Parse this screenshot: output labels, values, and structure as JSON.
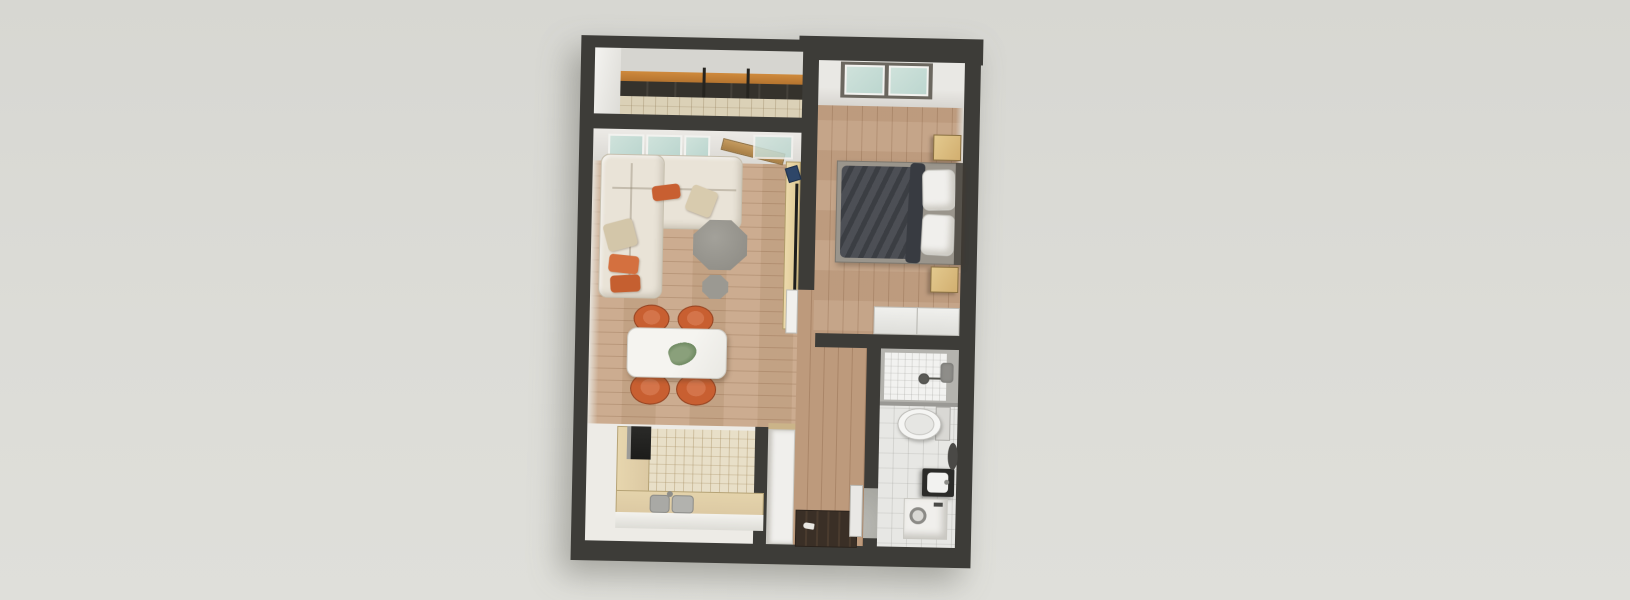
{
  "scene": {
    "description": "3D rendered top-down floor plan of a one-bedroom apartment",
    "view": "top-down axonometric render",
    "background_color": "#dcdcd7"
  },
  "palette": {
    "wall": "#3d3c38",
    "wood_living": "#c9a88a",
    "wood_bedroom": "#c2a083",
    "wood_corridor": "#bd9a7c",
    "tile_balcony": "#dbd1b7",
    "mosaic": "#e8dfc8",
    "bath_floor": "#e7e7e4",
    "sofa": "#e9e3d7",
    "orange": "#c85f31",
    "duvet": "#43464c",
    "counter": "#dcc9a3",
    "glass": "#bcd6cf",
    "white_furn": "#f0efec",
    "nightstand": "#d2af70",
    "rail_wood": "#b5742f"
  },
  "rooms": [
    {
      "id": "balcony",
      "label": "balcony",
      "features": [
        "railing-with-wood-handrail",
        "tile-floor"
      ]
    },
    {
      "id": "living-room",
      "label": "living-room",
      "features": [
        "corner-sofa",
        "orange-cushions",
        "octagonal-coffee-tables",
        "tv-console",
        "window",
        "balcony-door"
      ]
    },
    {
      "id": "dining-area",
      "label": "dining-area",
      "features": [
        "white-dining-table",
        "four-orange-chairs",
        "plant-centerpiece"
      ]
    },
    {
      "id": "kitchen",
      "label": "kitchen",
      "features": [
        "l-shaped-counter",
        "double-sink",
        "dark-appliance",
        "mosaic-tile-floor"
      ]
    },
    {
      "id": "bedroom",
      "label": "bedroom",
      "features": [
        "double-bed-dark-duvet",
        "white-pillows",
        "two-nightstands",
        "wardrobe",
        "window"
      ]
    },
    {
      "id": "hallway",
      "label": "hallway",
      "features": [
        "tall-white-cabinet",
        "dark-entry-mat"
      ]
    },
    {
      "id": "bathroom",
      "label": "bathroom",
      "features": [
        "shower",
        "toilet",
        "dark-vanity-sink",
        "washing-machine",
        "round-mirror"
      ]
    }
  ]
}
